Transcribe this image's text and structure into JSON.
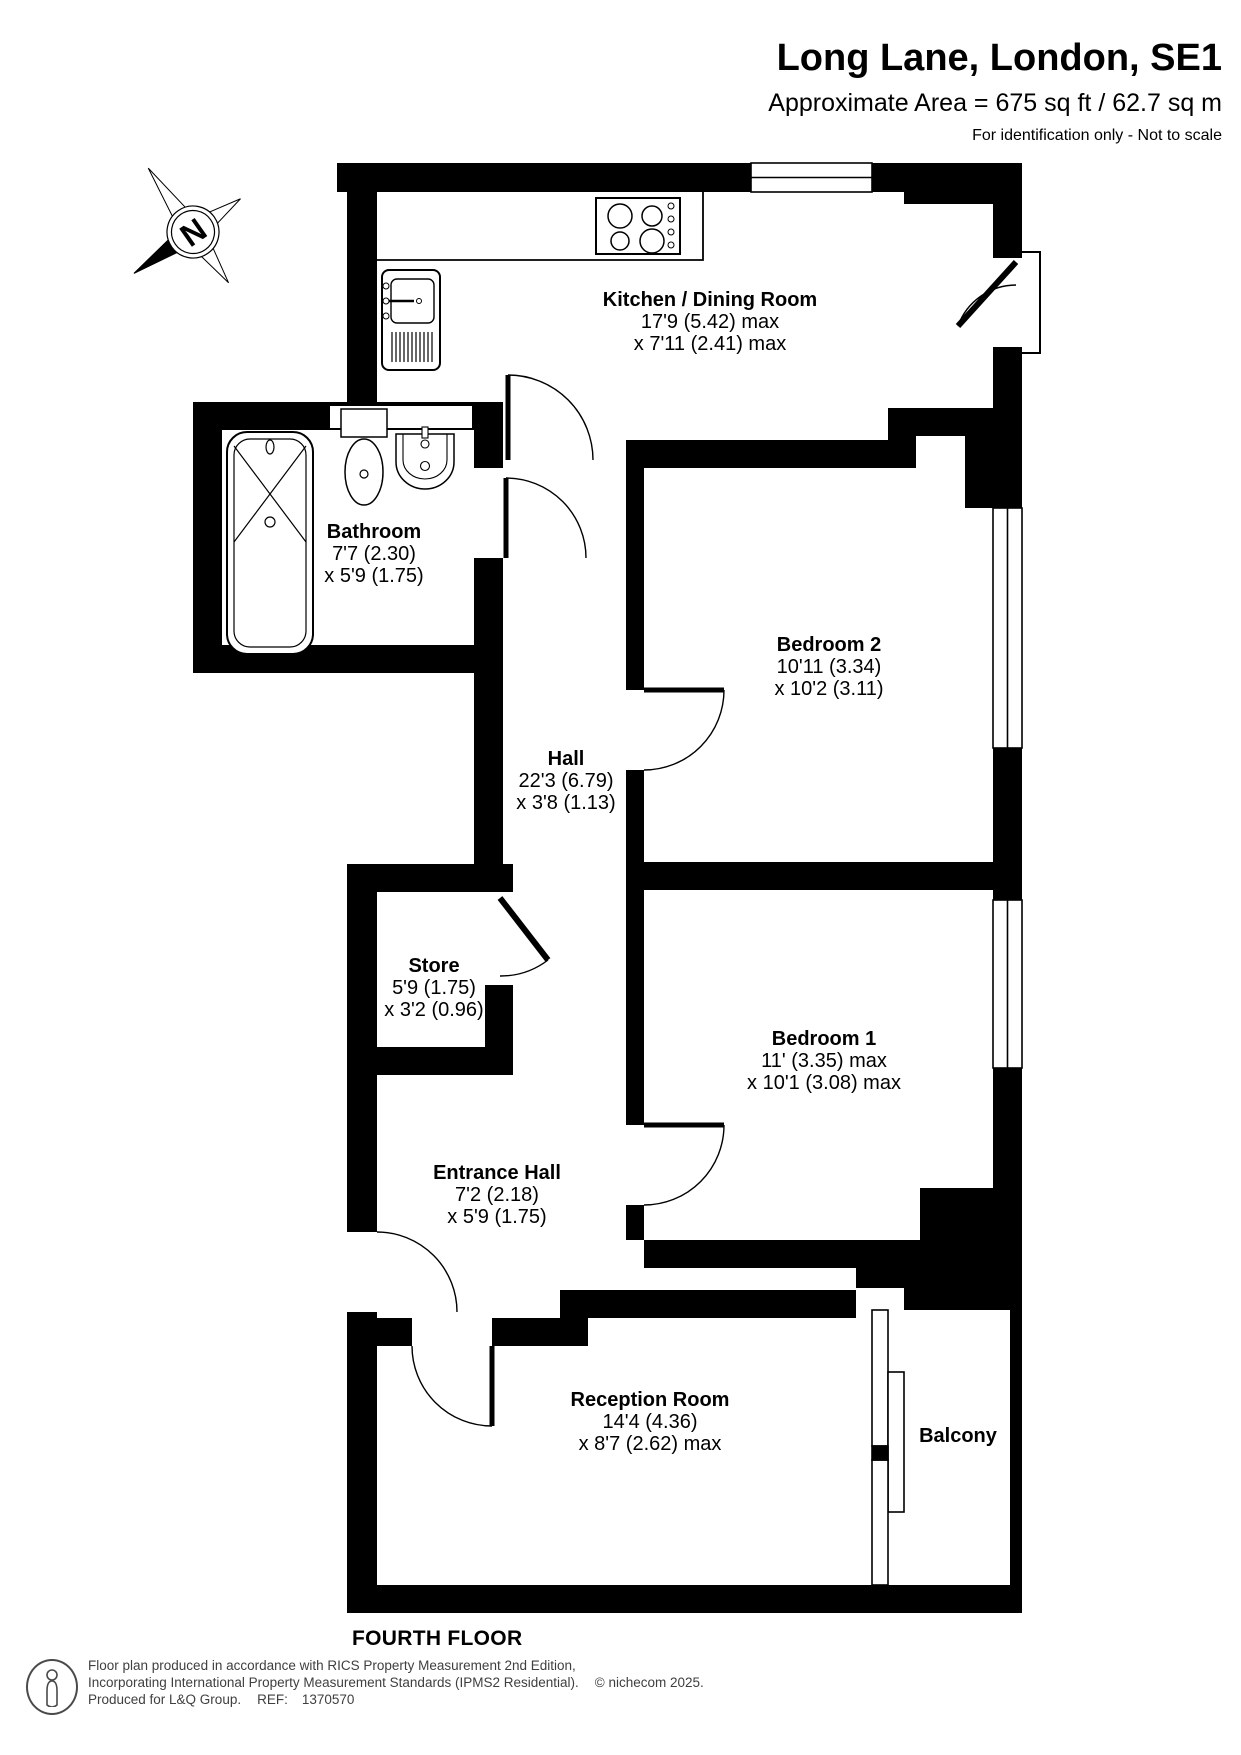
{
  "header": {
    "title": "Long Lane, London, SE1",
    "area_line": "Approximate Area = 675 sq ft / 62.7 sq m",
    "disclaimer": "For identification only - Not to scale"
  },
  "compass": {
    "label": "N"
  },
  "rooms": [
    {
      "id": "kitchen",
      "name": "Kitchen / Dining Room",
      "dim1": "17'9 (5.42) max",
      "dim2": "x 7'11 (2.41) max"
    },
    {
      "id": "bathroom",
      "name": "Bathroom",
      "dim1": "7'7 (2.30)",
      "dim2": "x 5'9 (1.75)"
    },
    {
      "id": "bedroom-2",
      "name": "Bedroom 2",
      "dim1": "10'11 (3.34)",
      "dim2": "x 10'2 (3.11)"
    },
    {
      "id": "hall",
      "name": "Hall",
      "dim1": "22'3 (6.79)",
      "dim2": "x 3'8 (1.13)"
    },
    {
      "id": "store",
      "name": "Store",
      "dim1": "5'9 (1.75)",
      "dim2": "x 3'2 (0.96)"
    },
    {
      "id": "bedroom-1",
      "name": "Bedroom 1",
      "dim1": "11' (3.35) max",
      "dim2": "x 10'1 (3.08) max"
    },
    {
      "id": "entrance-hall",
      "name": "Entrance Hall",
      "dim1": "7'2 (2.18)",
      "dim2": "x 5'9 (1.75)"
    },
    {
      "id": "reception",
      "name": "Reception Room",
      "dim1": "14'4 (4.36)",
      "dim2": "x 8'7 (2.62) max"
    },
    {
      "id": "balcony",
      "name": "Balcony"
    }
  ],
  "floor_label": "FOURTH FLOOR",
  "footer": {
    "line1": "Floor plan produced in accordance with RICS Property Measurement 2nd Edition,",
    "line2": "Incorporating International Property Measurement Standards (IPMS2 Residential).",
    "copyright": "© nichecom 2025.",
    "produced_for": "Produced for L&Q Group.",
    "ref_label": "REF:",
    "ref_value": "1370570"
  },
  "colors": {
    "wall": "#000000",
    "text": "#000000",
    "footer_text": "#3f3f3f"
  }
}
